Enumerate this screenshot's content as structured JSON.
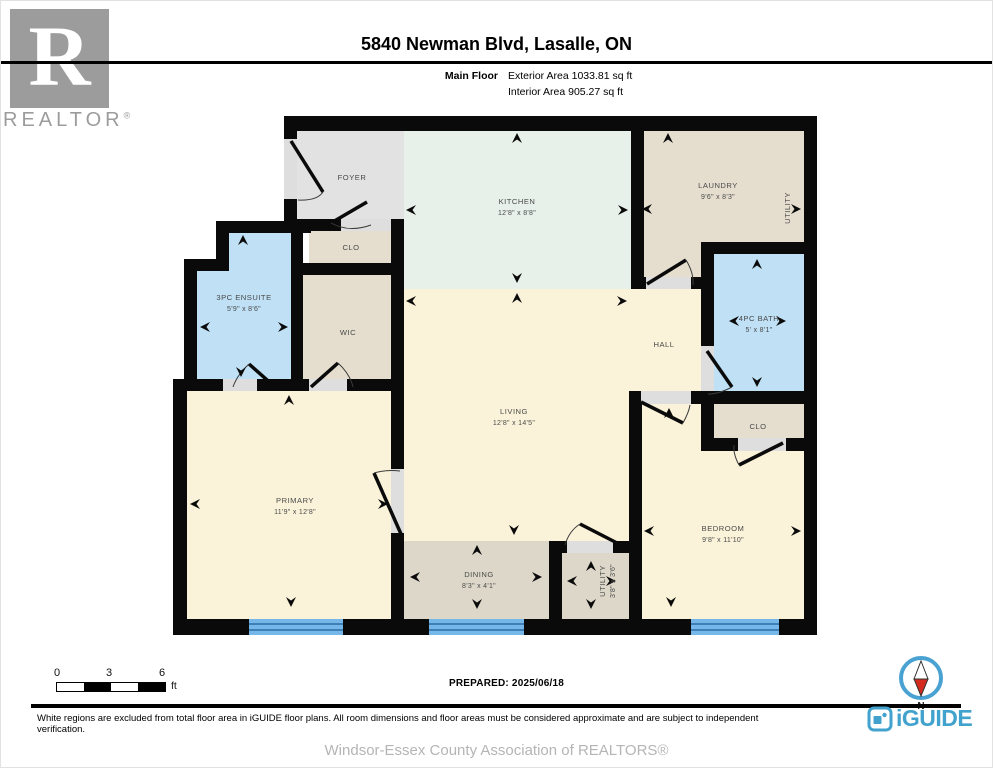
{
  "header": {
    "title": "5840 Newman Blvd, Lasalle, ON",
    "floor_label": "Main Floor",
    "exterior_area": "Exterior Area 1033.81 sq ft",
    "interior_area": "Interior Area 905.27 sq ft"
  },
  "branding": {
    "realtor_letter": "R",
    "realtor_text": "REALTOR",
    "registered": "®",
    "iguide_text": "iGUIDE"
  },
  "plan": {
    "rooms": [
      {
        "id": "foyer",
        "label": "FOYER",
        "dims": ""
      },
      {
        "id": "kitchen",
        "label": "KITCHEN",
        "dims": "12'8\" x 8'8\""
      },
      {
        "id": "laundry",
        "label": "LAUNDRY",
        "dims": "9'6\" x 8'3\""
      },
      {
        "id": "utility-side",
        "label": "UTILITY",
        "dims": ""
      },
      {
        "id": "closet-foyer",
        "label": "CLO",
        "dims": ""
      },
      {
        "id": "ensuite",
        "label": "3PC ENSUITE",
        "dims": "5'9\" x 8'6\""
      },
      {
        "id": "wic",
        "label": "WIC",
        "dims": ""
      },
      {
        "id": "hall",
        "label": "HALL",
        "dims": ""
      },
      {
        "id": "bath",
        "label": "4PC BATH",
        "dims": "5' x 8'1\""
      },
      {
        "id": "living",
        "label": "LIVING",
        "dims": "12'8\" x 14'5\""
      },
      {
        "id": "closet-bedroom",
        "label": "CLO",
        "dims": ""
      },
      {
        "id": "primary",
        "label": "PRIMARY",
        "dims": "11'9\" x 12'8\""
      },
      {
        "id": "dining",
        "label": "DINING",
        "dims": "8'3\" x 4'1\""
      },
      {
        "id": "utility-small",
        "label": "UTILITY",
        "dims": "3'8\" x 3'6\""
      },
      {
        "id": "bedroom",
        "label": "BEDROOM",
        "dims": "9'8\" x 11'10\""
      }
    ],
    "colors": {
      "wall": "#0a0a0a",
      "cream": "#faf3d9",
      "mint": "#e7f0e9",
      "beige": "#e5decf",
      "taupe": "#dcd7c8",
      "blue": "#bfe0f5",
      "gray": "#e2e2e2",
      "window": "#74b7e8"
    }
  },
  "scale_bar": {
    "tick0": "0",
    "tick3": "3",
    "tick6": "6",
    "unit": "ft"
  },
  "footer": {
    "prepared": "PREPARED: 2025/06/18",
    "compass_label": "N",
    "disclaimer": "White regions are excluded from total floor area in iGUIDE floor plans. All room dimensions and floor areas must be considered approximate and are subject to independent verification.",
    "association": "Windsor-Essex County Association of REALTORS®"
  }
}
